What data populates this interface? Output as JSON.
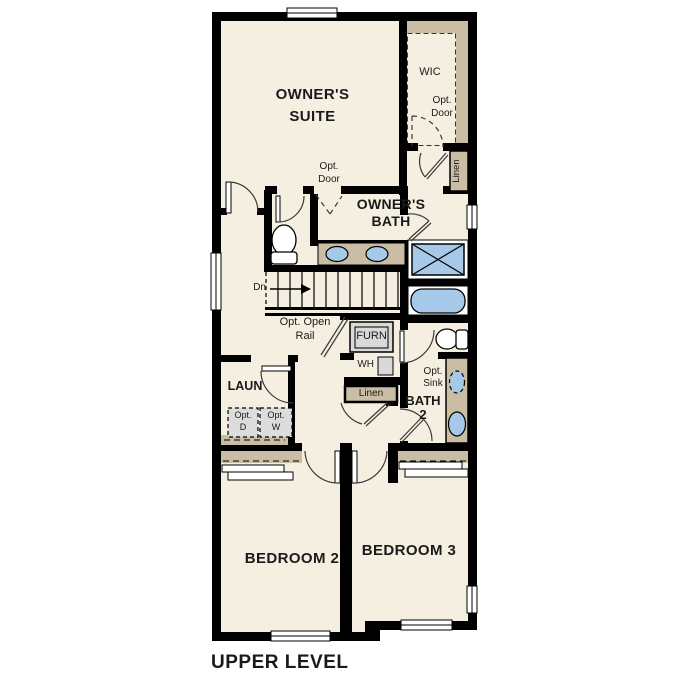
{
  "plan": {
    "title": "UPPER LEVEL",
    "rooms": {
      "owners_suite": {
        "line1": "OWNER'S",
        "line2": "SUITE"
      },
      "wic": {
        "label": "WIC"
      },
      "owners_bath": {
        "line1": "OWNER'S",
        "line2": "BATH"
      },
      "laundry": {
        "label": "LAUN"
      },
      "bath2": {
        "line1": "BATH",
        "line2": "2"
      },
      "bedroom2": {
        "label": "BEDROOM 2"
      },
      "bedroom3": {
        "label": "BEDROOM 3"
      }
    },
    "labels": {
      "opt_door_wic": {
        "line1": "Opt.",
        "line2": "Door"
      },
      "opt_door_suite": {
        "line1": "Opt.",
        "line2": "Door"
      },
      "linen_closet": {
        "label": "Linen"
      },
      "linen_hall": {
        "label": "Linen"
      },
      "stair_direction": {
        "label": "Dn"
      },
      "opt_open_rail": {
        "line1": "Opt. Open",
        "line2": "Rail"
      },
      "furnace": {
        "label": "FURN"
      },
      "water_heater": {
        "label": "WH"
      },
      "opt_dryer": {
        "line1": "Opt.",
        "line2": "D"
      },
      "opt_washer": {
        "line1": "Opt.",
        "line2": "W"
      },
      "opt_sink": {
        "line1": "Opt.",
        "line2": "Sink"
      }
    },
    "colors": {
      "floor": "#f5efe2",
      "wall": "#000000",
      "accent_tan": "#c9bda3",
      "fixture_blue": "#a6c9e9",
      "appliance_gray": "#d9d9d9",
      "text": "#1a1a1a"
    }
  }
}
